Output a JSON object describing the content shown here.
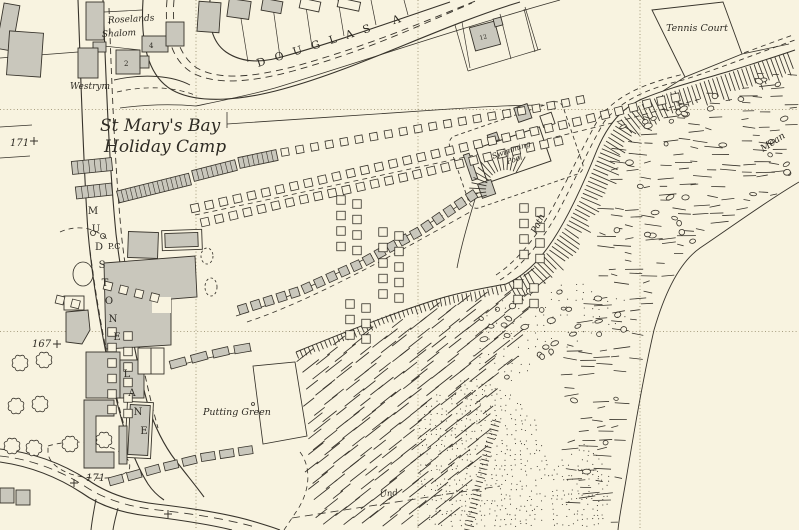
{
  "map": {
    "colors": {
      "background": "#f8f3e0",
      "ink": "#37332b",
      "building_fill": "#c9c7bc",
      "grid": "#8d8362"
    },
    "place_labels": {
      "holiday_camp_line1": "St Mary's Bay",
      "holiday_camp_line2": "Holiday Camp",
      "tennis_court": "Tennis Court",
      "swimming_pool_line1": "Swimming",
      "swimming_pool_line2": "Pool",
      "putting_green": "Putting Green",
      "douglas_avenue": "DOUGLAS A",
      "mudstone_lane": "MUDSTONE LANE",
      "path": "Path",
      "mean": "Mean",
      "und": "Und",
      "pc": "P.C",
      "roselands": "Roselands",
      "shalom": "Shalom",
      "westrym": "Westrym"
    },
    "spot_heights": [
      {
        "label": "171"
      },
      {
        "label": "167"
      },
      {
        "label": "171"
      }
    ],
    "house_numbers": [
      "4",
      "2",
      "12"
    ]
  }
}
